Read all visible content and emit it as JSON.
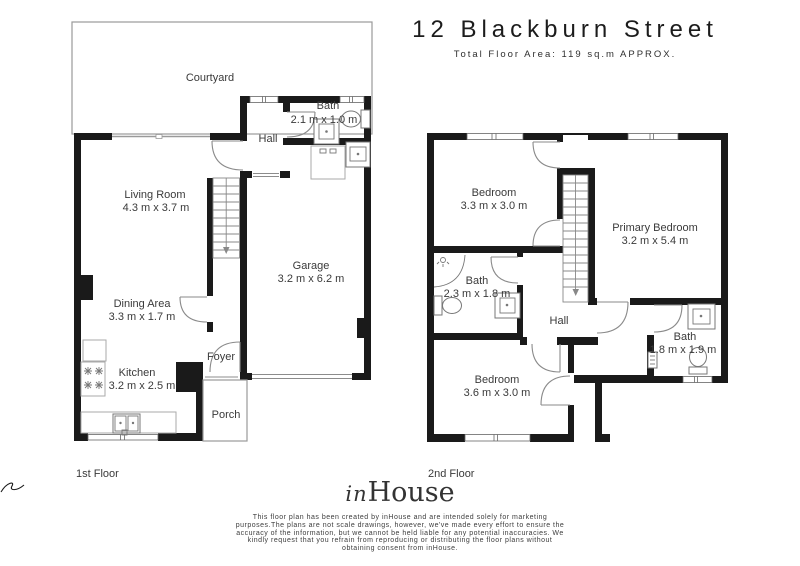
{
  "header": {
    "title": "12 Blackburn Street",
    "subtitle": "Total Floor Area: 119  sq.m APPROX."
  },
  "floors": {
    "first": {
      "label": "1st Floor",
      "rooms": {
        "courtyard": {
          "name": "Courtyard"
        },
        "hall": {
          "name": "Hall"
        },
        "bath": {
          "name": "Bath",
          "dims": "2.1 m x 1.0 m"
        },
        "living": {
          "name": "Living Room",
          "dims": "4.3 m x 3.7 m"
        },
        "garage": {
          "name": "Garage",
          "dims": "3.2 m x 6.2 m"
        },
        "dining": {
          "name": "Dining Area",
          "dims": "3.3 m x 1.7 m"
        },
        "kitchen": {
          "name": "Kitchen",
          "dims": "3.2 m x 2.5 m"
        },
        "foyer": {
          "name": "Foyer"
        },
        "porch": {
          "name": "Porch"
        }
      }
    },
    "second": {
      "label": "2nd Floor",
      "rooms": {
        "bedroom1": {
          "name": "Bedroom",
          "dims": "3.3 m x 3.0 m"
        },
        "primary": {
          "name": "Primary Bedroom",
          "dims": "3.2 m x 5.4 m"
        },
        "bath1": {
          "name": "Bath",
          "dims": "2.3 m x 1.8 m"
        },
        "hall": {
          "name": "Hall"
        },
        "bath2": {
          "name": "Bath",
          "dims": "1.8 m x 1.9 m"
        },
        "bedroom2": {
          "name": "Bedroom",
          "dims": "3.6 m x 3.0 m"
        }
      }
    }
  },
  "footer": {
    "logo_in": "in",
    "logo_house": "House",
    "disclaimer": "This floor plan has been created by inHouse and are intended solely for marketing purposes.The plans are not scale drawings, however, we've made every effort to ensure the accuracy of the information, but we cannot be held liable for any potential inaccuracies. We kindly request that you refrain from reproducing or distributing the floor plans without obtaining consent from inHouse."
  },
  "colors": {
    "wall": "#1a1a1a",
    "thin_line": "#9a9a9a",
    "text": "#3a3a3a"
  }
}
